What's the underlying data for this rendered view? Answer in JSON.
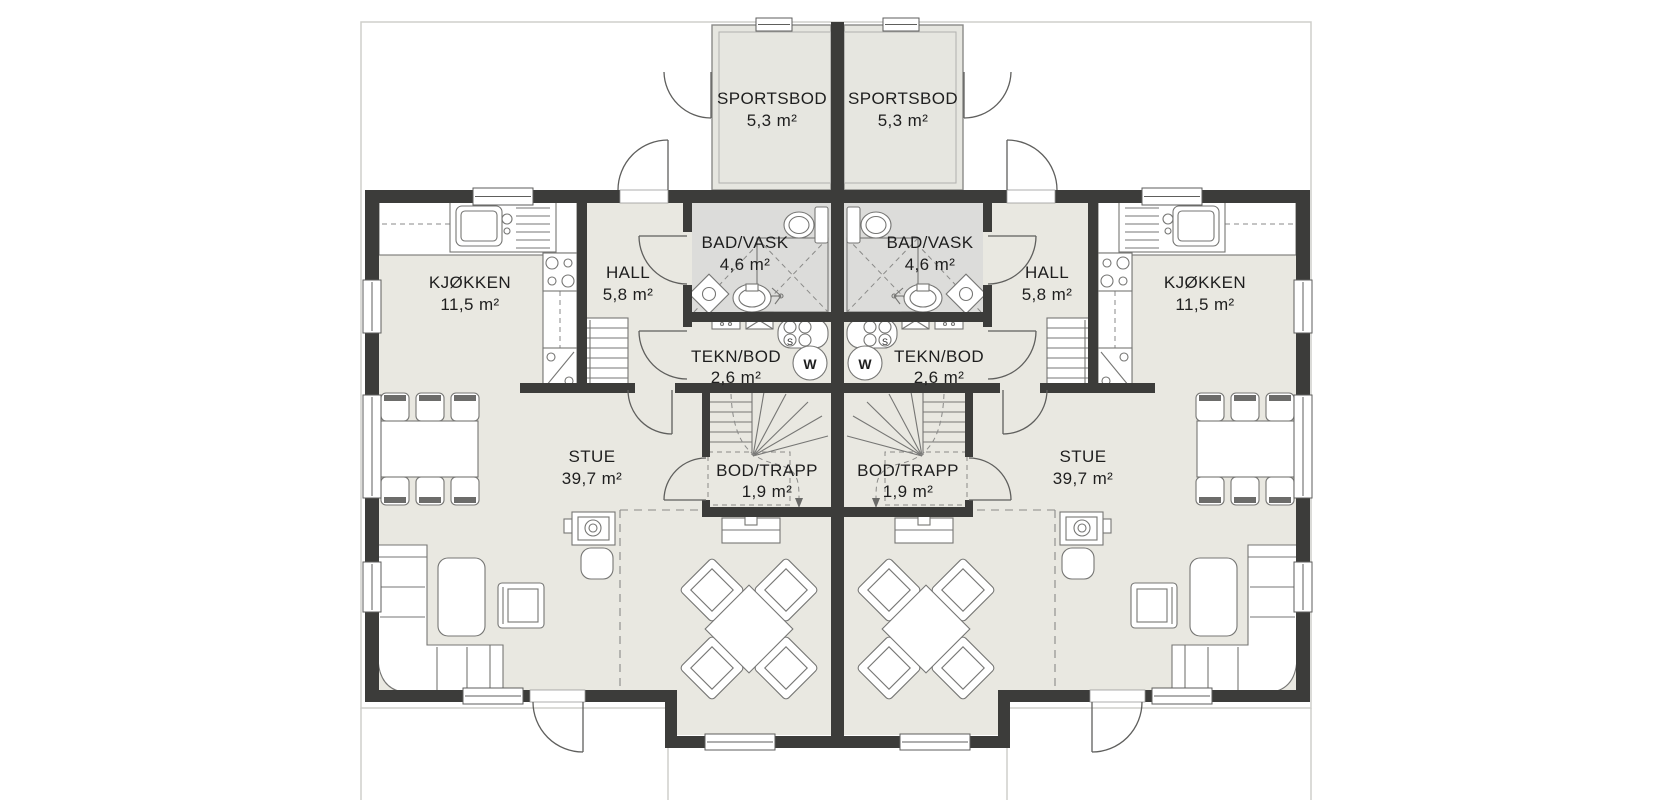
{
  "canvas": {
    "width": 1670,
    "height": 800,
    "background": "#ffffff"
  },
  "colors": {
    "wall": "#3c3c3a",
    "floor": "#e9e8e1",
    "wet_room": "#dcdcda",
    "storage_room": "#e6e6e0",
    "site_outline": "#cfcfcb",
    "fixture_stroke": "#767674",
    "label_text": "#1e1e1e"
  },
  "plan_type": "duplex-ground-floor",
  "units": [
    {
      "id": "left",
      "rooms": [
        {
          "name": "KJØKKEN",
          "area": "11,5 m²"
        },
        {
          "name": "HALL",
          "area": "5,8 m²"
        },
        {
          "name": "BAD/VASK",
          "area": "4,6 m²"
        },
        {
          "name": "TEKN/BOD",
          "area": "2,6 m²"
        },
        {
          "name": "STUE",
          "area": "39,7 m²"
        },
        {
          "name": "BOD/TRAPP",
          "area": "1,9 m²"
        },
        {
          "name": "SPORTSBOD",
          "area": "5,3 m²"
        }
      ]
    },
    {
      "id": "right",
      "rooms": [
        {
          "name": "KJØKKEN",
          "area": "11,5 m²"
        },
        {
          "name": "HALL",
          "area": "5,8 m²"
        },
        {
          "name": "BAD/VASK",
          "area": "4,6 m²"
        },
        {
          "name": "TEKN/BOD",
          "area": "2,6 m²"
        },
        {
          "name": "STUE",
          "area": "39,7 m²"
        },
        {
          "name": "BOD/TRAPP",
          "area": "1,9 m²"
        },
        {
          "name": "SPORTSBOD",
          "area": "5,3 m²"
        }
      ]
    }
  ],
  "appliances": {
    "washer_label": "W",
    "drain_label": "S"
  }
}
